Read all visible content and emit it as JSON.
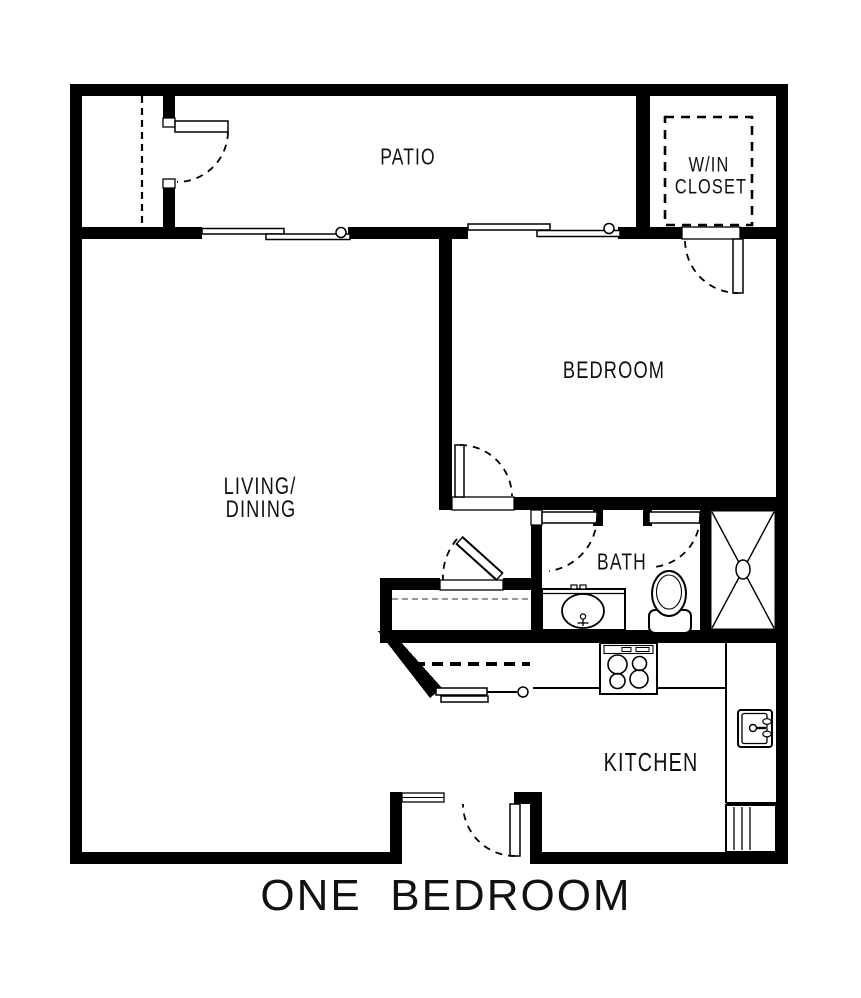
{
  "plan": {
    "title": "ONE  BEDROOM",
    "rooms": {
      "patio": {
        "label": "PATIO"
      },
      "walk_in_closet": {
        "lines": [
          "W/IN",
          "CLOSET"
        ]
      },
      "bedroom": {
        "label": "BEDROOM"
      },
      "living_dining": {
        "lines": [
          "LIVING/",
          "DINING"
        ]
      },
      "bath": {
        "label": "BATH"
      },
      "kitchen": {
        "label": "KITCHEN"
      }
    },
    "colors": {
      "wall": "#000000",
      "line": "#000000",
      "background": "#ffffff",
      "text": "#111111"
    },
    "fixtures": [
      "shower-stall",
      "toilet",
      "vanity-sink",
      "kitchen-sink",
      "range-cooktop",
      "counter",
      "appliance-cabinet",
      "sliding-glass-door-living",
      "sliding-glass-door-bedroom",
      "closet-bypass-door",
      "hinged-door",
      "entry-sidelight",
      "closet-rod-dashed",
      "walk-in-closet-shelf-dashed"
    ]
  }
}
